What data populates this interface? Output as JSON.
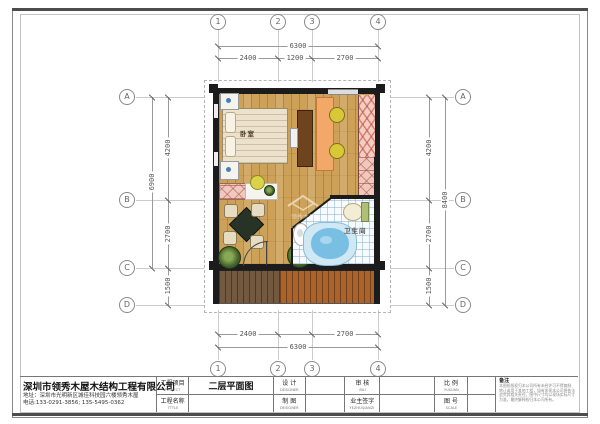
{
  "sheet_title": "二层平面图",
  "grid": {
    "cols": [
      "1",
      "2",
      "3",
      "4"
    ],
    "rows": [
      "A",
      "B",
      "C",
      "D"
    ]
  },
  "dimensions": {
    "top": {
      "total": "6300",
      "segments": [
        "2400",
        "1200",
        "2700"
      ]
    },
    "bottom": {
      "total": "6300",
      "segments": [
        "2400",
        "2700"
      ]
    },
    "left": {
      "total": "6900",
      "segments": [
        "4200",
        "2700",
        "1500"
      ]
    },
    "right": {
      "total": "8400",
      "segments": [
        "4200",
        "2700",
        "1500"
      ]
    }
  },
  "plan": {
    "bedroom_label": "卧室",
    "bathroom_label": "卫生间",
    "watermark": "领秀木屋"
  },
  "title_block": {
    "company_name": "深圳市领秀木屋木结构工程有限公司",
    "company_address": "地址：深圳市光明新区城佳科技园六楼领秀木屋",
    "company_phone": "电话:133-0291-3856; 135-5495-0362",
    "fields": [
      {
        "zh": "工程项目",
        "en": "PROJECT",
        "value": "二层平面图"
      },
      {
        "zh": "工程名称",
        "en": "TTTLE",
        "value": ""
      },
      {
        "zh": "设 计",
        "en": "DESIGNER",
        "value": ""
      },
      {
        "zh": "制 图",
        "en": "DESIGNER",
        "value": ""
      },
      {
        "zh": "审 核",
        "en": "BILI",
        "value": ""
      },
      {
        "zh": "业主签字",
        "en": "YEZHUQIANZI",
        "value": ""
      },
      {
        "zh": "比 例",
        "en": "YUSUAN",
        "value": ""
      },
      {
        "zh": "图 号",
        "en": "SCALE",
        "value": ""
      }
    ],
    "notes_label": "备注",
    "notes_lines": [
      "本图纸版权归本公司所有未经许可不得复制、",
      "转让或用于其他工程，如有发现本公司将依法",
      "追究其相关责任，图中尺寸均以现场实际尺寸",
      "为准，最终解释权归本公司所有。"
    ]
  },
  "colors": {
    "wall": "#1c1c1c",
    "wood_floor": "#cda158",
    "deck_left": "#72593f",
    "deck_right": "#a9632c",
    "tub_water": "#79bfe4",
    "stair_pink": "#f2c8c0",
    "hatch_red": "#b4503c",
    "tile": "#f7fbfd"
  }
}
